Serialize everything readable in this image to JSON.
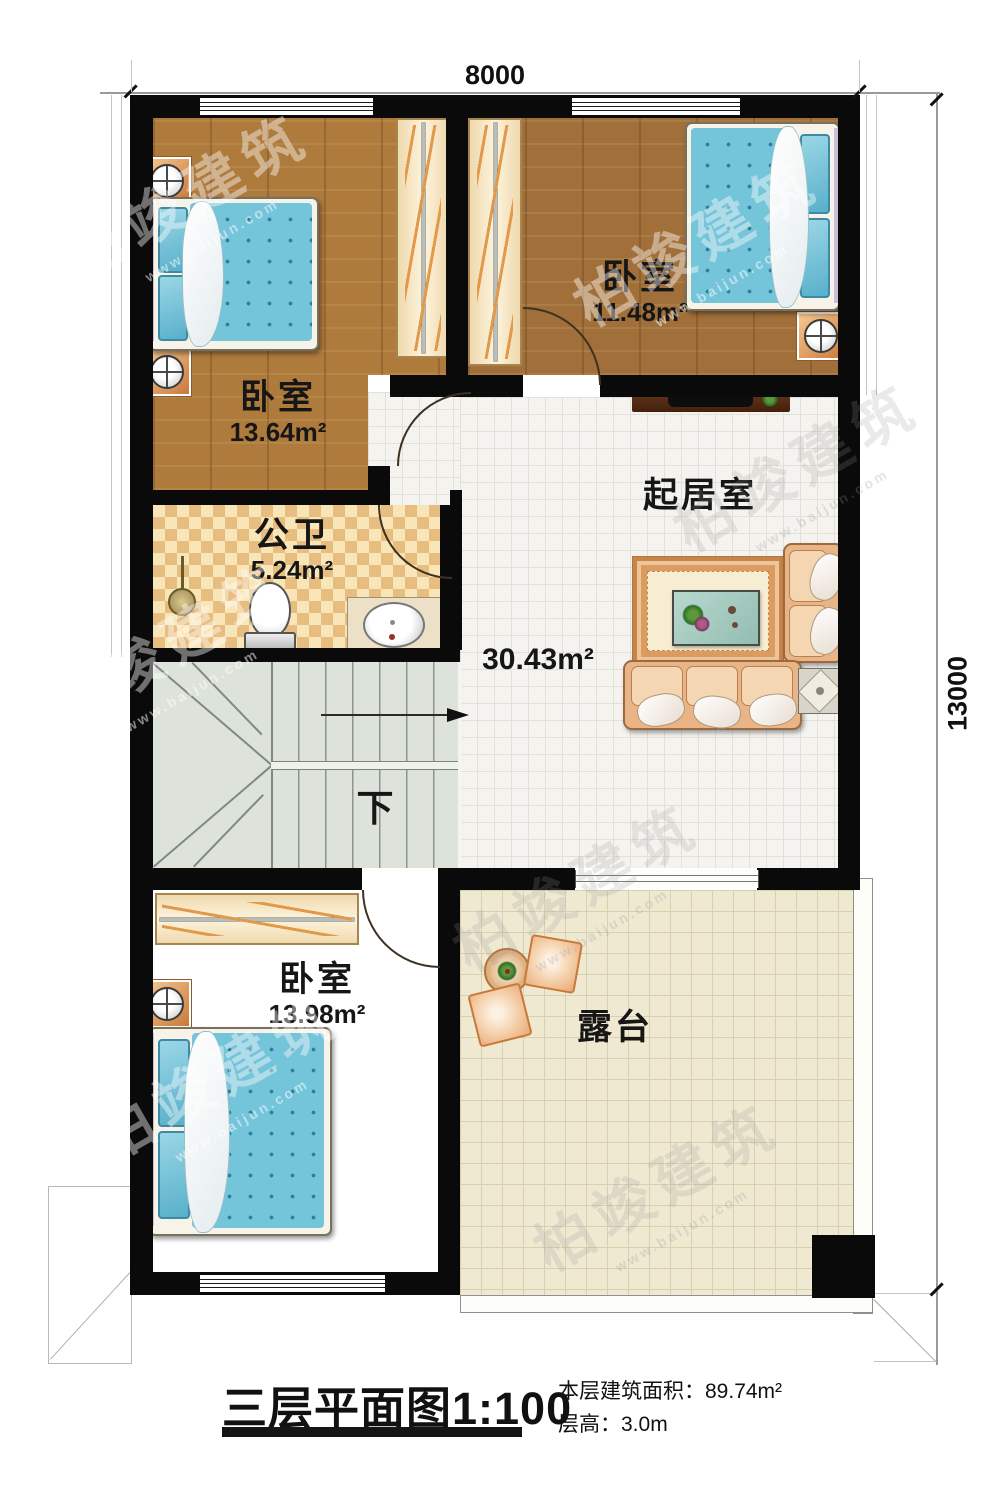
{
  "dimensions": {
    "top": "8000",
    "right": "13000"
  },
  "rooms": {
    "bedroom_top_left": {
      "label": "卧室",
      "area": "13.64m²"
    },
    "bedroom_top_right": {
      "label": "卧室",
      "area": "11.48m²"
    },
    "bathroom": {
      "label": "公卫",
      "area": "5.24m²"
    },
    "living_room": {
      "label": "起居室",
      "area": "30.43m²"
    },
    "bedroom_bottom": {
      "label": "卧室",
      "area": "13.98m²"
    },
    "terrace": {
      "label": "露台"
    }
  },
  "stairs": {
    "direction_label": "下"
  },
  "title_block": {
    "title": "三层平面图",
    "scale": "1:100",
    "area_label": "本层建筑面积：",
    "area_value": "89.74m²",
    "floor_height_label": "层高：",
    "floor_height_value": "3.0m"
  },
  "watermark": {
    "brand": "柏竣建筑",
    "url": "www.baijun.com"
  }
}
